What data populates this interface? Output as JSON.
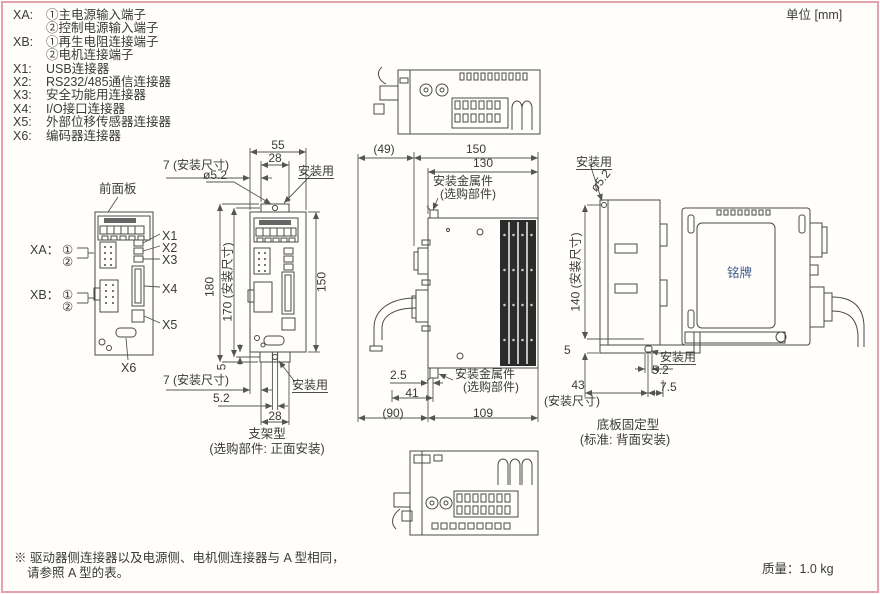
{
  "page": {
    "unit_note": "单位 [mm]",
    "mass": "质量：1.0 kg",
    "footnote1": "※ 驱动器侧连接器以及电源侧、电机侧连接器与 A 型相同，",
    "footnote2": "请参照 A 型的表。"
  },
  "legend": {
    "items": [
      {
        "key": "XA:",
        "text": "①主电源输入端子"
      },
      {
        "key": "",
        "text": "②控制电源输入端子"
      },
      {
        "key": "XB:",
        "text": "①再生电阻连接端子"
      },
      {
        "key": "",
        "text": "②电机连接端子"
      },
      {
        "key": "X1:",
        "text": "USB连接器"
      },
      {
        "key": "X2:",
        "text": "RS232/485通信连接器"
      },
      {
        "key": "X3:",
        "text": "安全功能用连接器"
      },
      {
        "key": "X4:",
        "text": "I/O接口连接器"
      },
      {
        "key": "X5:",
        "text": "外部位移传感器连接器"
      },
      {
        "key": "X6:",
        "text": "编码器连接器"
      }
    ]
  },
  "front_view": {
    "panel": "前面板",
    "xa": "XA：",
    "xa1": "①",
    "xa2": "②",
    "xb": "XB：",
    "xb1": "①",
    "xb2": "②",
    "x1": "X1",
    "x2": "X2",
    "x3": "X3",
    "x4": "X4",
    "x5": "X5",
    "x6": "X6"
  },
  "bracket_view": {
    "d55": "55",
    "d28t": "28",
    "d7t": "7 (安装尺寸)",
    "hole": "ø5.2",
    "mount_t": "安装用",
    "d180": "180",
    "d170": "170 (安装尺寸)",
    "d150": "150",
    "d5": "5",
    "d7b": "7 (安装尺寸)",
    "d52": "5.2",
    "d28b": "28",
    "mount_b": "安装用",
    "cap1": "支架型",
    "cap2": "(选购部件: 正面安装)"
  },
  "side_view": {
    "d49": "(49)",
    "d150": "150",
    "d130": "130",
    "bkt1": "安装金属件",
    "bkt2": "(选购部件)",
    "bkb1": "安装金属件",
    "bkb2": "(选购部件)",
    "d25": "2.5",
    "d41": "41",
    "d90": "(90)",
    "d109": "109"
  },
  "base_view": {
    "mount_t": "安装用",
    "hole": "ø5.2",
    "d140": "140 (安装尺寸)",
    "d5": "5",
    "mount_b": "安装用",
    "d52": "5.2",
    "d75": "7.5",
    "d43": "43",
    "d43s": "(安装尺寸)",
    "cap1": "底板固定型",
    "cap2": "(标准: 背面安装)"
  },
  "rear_view": {
    "nameplate": "铭牌"
  }
}
